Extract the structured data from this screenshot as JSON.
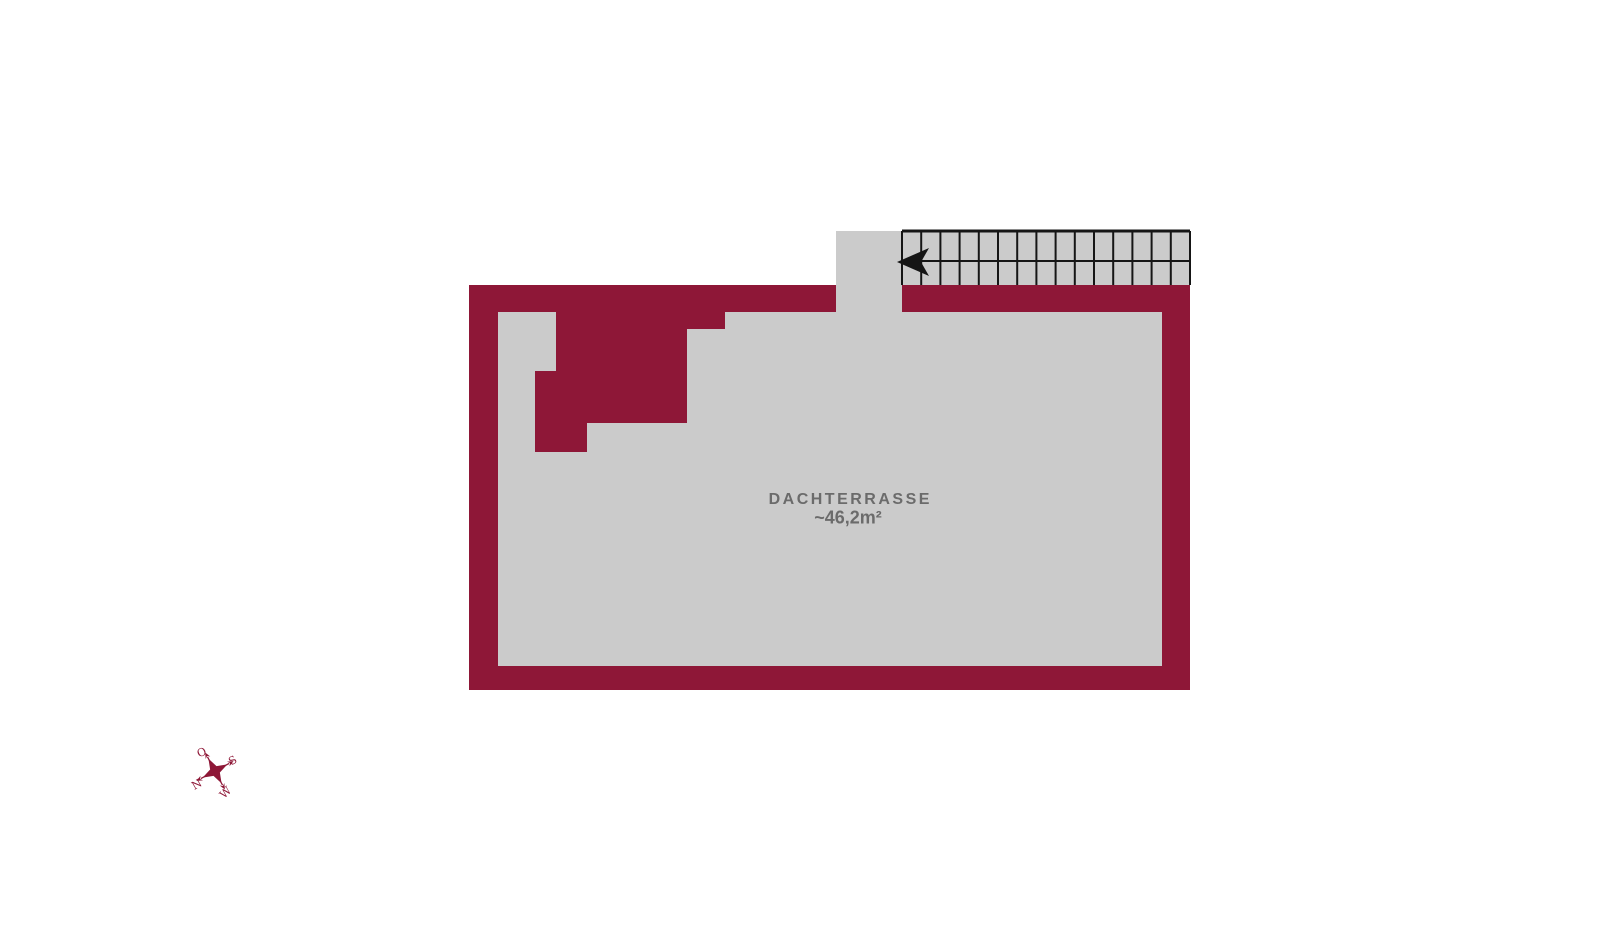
{
  "colors": {
    "background": "#ffffff",
    "wall": "#8e1737",
    "floor": "#cbcbcb",
    "stair_line": "#151515",
    "label": "#6b6b6b",
    "compass": "#8e1737"
  },
  "room": {
    "name": "DACHTERRASSE",
    "area": "~46,2m²"
  },
  "stairs": {
    "treads": 15,
    "direction": "left"
  },
  "compass": {
    "north": "N",
    "east": "O",
    "south": "S",
    "west": "W"
  }
}
